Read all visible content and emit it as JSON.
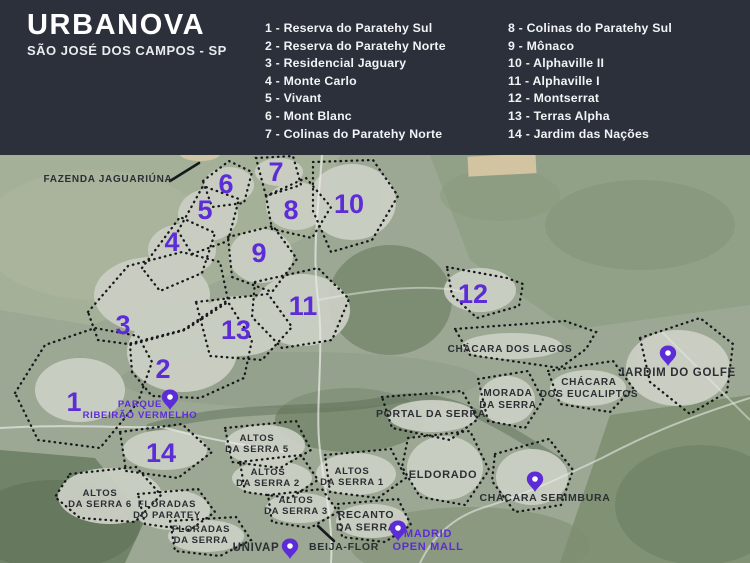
{
  "header": {
    "title": "URBANOVA",
    "subtitle": "SÃO JOSÉ DOS CAMPOS - SP",
    "legend_col1": [
      "1 - Reserva do Paratehy Sul",
      "2 - Reserva do Paratehy Norte",
      "3 - Residencial Jaguary",
      "4 - Monte Carlo",
      "5 - Vivant",
      "6 - Mont Blanc",
      "7 - Colinas do Paratehy Norte"
    ],
    "legend_col2": [
      "8 - Colinas do Paratehy Sul",
      "9 - Mônaco",
      "10 - Alphaville II",
      "11 - Alphaville I",
      "12 - Montserrat",
      "13 - Terras Alpha",
      "14 - Jardim das Nações"
    ]
  },
  "colors": {
    "header_bg": "#2b303a",
    "accent_purple": "#5c2cd6",
    "label_dark": "#2b2f34",
    "outline_dark": "#17181c"
  },
  "map": {
    "numbers": [
      {
        "n": "1",
        "x": 74,
        "y": 411
      },
      {
        "n": "2",
        "x": 163,
        "y": 378
      },
      {
        "n": "3",
        "x": 123,
        "y": 334
      },
      {
        "n": "4",
        "x": 172,
        "y": 251
      },
      {
        "n": "5",
        "x": 205,
        "y": 219
      },
      {
        "n": "6",
        "x": 226,
        "y": 193
      },
      {
        "n": "7",
        "x": 276,
        "y": 181
      },
      {
        "n": "8",
        "x": 291,
        "y": 219
      },
      {
        "n": "9",
        "x": 259,
        "y": 262
      },
      {
        "n": "10",
        "x": 349,
        "y": 213
      },
      {
        "n": "11",
        "x": 303,
        "y": 315
      },
      {
        "n": "12",
        "x": 473,
        "y": 303
      },
      {
        "n": "13",
        "x": 236,
        "y": 339
      },
      {
        "n": "14",
        "x": 161,
        "y": 462
      }
    ],
    "regions": [
      {
        "name": "reserva-do-paratehy-sul",
        "points": "15,393 45,345 95,328 138,336 152,362 138,402 100,448 38,440"
      },
      {
        "name": "reserva-do-paratehy-norte",
        "points": "132,372 130,345 185,330 228,302 252,340 244,378 200,398 152,396"
      },
      {
        "name": "residencial-jaguary",
        "points": "88,312 128,266 182,252 220,262 228,300 183,330 128,344 98,340"
      },
      {
        "name": "monte-carlo",
        "points": "142,268 180,217 215,233 202,273 160,291"
      },
      {
        "name": "vivant",
        "points": "178,231 203,186 239,199 228,241 192,254"
      },
      {
        "name": "mont-blanc",
        "points": "203,181 229,161 252,172 244,203 212,207"
      },
      {
        "name": "colinas-do-paratehy-norte",
        "points": "256,158 293,156 301,185 266,196"
      },
      {
        "name": "colinas-do-paratehy-sul",
        "points": "266,196 306,178 331,207 312,238 272,229"
      },
      {
        "name": "monaco",
        "points": "228,237 273,226 297,259 272,292 232,277"
      },
      {
        "name": "alphaville-2",
        "points": "313,162 373,160 398,196 372,240 331,252 313,211"
      },
      {
        "name": "alphaville-1",
        "points": "255,282 318,268 349,299 332,340 282,348 252,317"
      },
      {
        "name": "montserrat",
        "points": "447,267 507,278 523,284 519,306 477,318 452,295"
      },
      {
        "name": "terras-alpha",
        "points": "196,302 268,294 292,327 262,360 210,356"
      },
      {
        "name": "jardim-das-nacoes",
        "points": "120,432 182,424 212,452 178,478 126,471"
      },
      {
        "name": "altos-da-serra-5",
        "points": "225,428 296,421 311,450 280,468 232,462"
      },
      {
        "name": "altos-da-serra-2",
        "points": "240,462 301,455 318,480 290,498 245,492"
      },
      {
        "name": "altos-da-serra-1",
        "points": "325,455 391,449 406,478 378,498 330,492"
      },
      {
        "name": "altos-da-serra-3",
        "points": "268,495 322,489 338,512 310,528 272,522"
      },
      {
        "name": "altos-da-serra-6",
        "points": "70,474 136,467 161,495 135,522 80,518 55,497"
      },
      {
        "name": "floradas-do-paratey",
        "points": "138,494 198,489 215,512 190,530 145,524"
      },
      {
        "name": "floradas-da-serra",
        "points": "170,521 236,517 251,540 220,556 175,551"
      },
      {
        "name": "recanto-da-serra",
        "points": "338,504 398,499 411,525 385,542 342,537"
      },
      {
        "name": "eldorado",
        "points": "408,438 470,431 489,470 465,505 420,497 402,467"
      },
      {
        "name": "chacara-serimbura",
        "points": "495,454 549,439 573,470 561,505 515,512 492,481"
      },
      {
        "name": "morada-da-serra",
        "points": "478,379 528,371 543,400 525,428 488,421"
      },
      {
        "name": "chacara-dos-eucaliptos",
        "points": "548,371 613,361 633,388 610,412 560,404"
      },
      {
        "name": "chacara-dos-lagos",
        "points": "455,329 565,321 596,332 586,349 560,368 470,355"
      },
      {
        "name": "jardim-do-golfe",
        "points": "640,338 700,318 733,344 727,392 690,414 650,382"
      },
      {
        "name": "portal-da-serra",
        "points": "382,397 462,391 478,419 450,440 392,428"
      }
    ],
    "labels": [
      {
        "name": "fazenda-jaguariuna",
        "lines": [
          "FAZENDA JAGUARIÚNA"
        ],
        "x": 108,
        "y": 182,
        "size": 10
      },
      {
        "name": "chacara-dos-lagos",
        "lines": [
          "CHÁCARA DOS LAGOS"
        ],
        "x": 510,
        "y": 352,
        "size": 10
      },
      {
        "name": "jardim-do-golfe",
        "lines": [
          "JARDIM DO GOLFE"
        ],
        "x": 677,
        "y": 376,
        "size": 11.5
      },
      {
        "name": "chacara-dos-eucaliptos",
        "lines": [
          "CHÁCARA",
          "DOS EUCALIPTOS"
        ],
        "x": 589,
        "y": 385,
        "size": 10
      },
      {
        "name": "morada-da-serra",
        "lines": [
          "MORADA",
          "DA SERRA"
        ],
        "x": 508,
        "y": 396,
        "size": 10
      },
      {
        "name": "portal-da-serra",
        "lines": [
          "PORTAL DA SERRA"
        ],
        "x": 431,
        "y": 417,
        "size": 10.5
      },
      {
        "name": "altos-da-serra-5",
        "lines": [
          "ALTOS",
          "DA SERRA 5"
        ],
        "x": 257,
        "y": 441,
        "size": 9.5
      },
      {
        "name": "altos-da-serra-2",
        "lines": [
          "ALTOS",
          "DA SERRA 2"
        ],
        "x": 268,
        "y": 475,
        "size": 9.5
      },
      {
        "name": "altos-da-serra-1",
        "lines": [
          "ALTOS",
          "DA SERRA 1"
        ],
        "x": 352,
        "y": 474,
        "size": 9.5
      },
      {
        "name": "eldorado",
        "lines": [
          "ELDORADO"
        ],
        "x": 443,
        "y": 478,
        "size": 11
      },
      {
        "name": "altos-da-serra-6",
        "lines": [
          "ALTOS",
          "DA SERRA 6"
        ],
        "x": 100,
        "y": 496,
        "size": 9.5
      },
      {
        "name": "floradas-do-paratey",
        "lines": [
          "FLORADAS",
          "DO PARATEY"
        ],
        "x": 167,
        "y": 507,
        "size": 9.5
      },
      {
        "name": "altos-da-serra-3",
        "lines": [
          "ALTOS",
          "DA SERRA 3"
        ],
        "x": 296,
        "y": 503,
        "size": 9.5
      },
      {
        "name": "floradas-da-serra",
        "lines": [
          "FLORADAS",
          "DA SERRA"
        ],
        "x": 201,
        "y": 532,
        "size": 9.5
      },
      {
        "name": "recanto-da-serra",
        "lines": [
          "RECANTO",
          "DA SERRA"
        ],
        "x": 366,
        "y": 518,
        "size": 10.5
      },
      {
        "name": "univap",
        "lines": [
          "UNIVAP"
        ],
        "x": 256,
        "y": 551,
        "size": 11.5
      },
      {
        "name": "beija-flor",
        "lines": [
          "BEIJA-FLOR"
        ],
        "x": 344,
        "y": 550,
        "size": 10.5
      },
      {
        "name": "chacara-serimbura",
        "lines": [
          "CHÁCARA SERIMBURA"
        ],
        "x": 545,
        "y": 501,
        "size": 10.5
      },
      {
        "name": "parque-ribeirao-vermelho",
        "lines": [
          "PARQUE",
          "RIBEIRÃO VERMELHO"
        ],
        "x": 140,
        "y": 407,
        "size": 9.5,
        "color": "purple"
      },
      {
        "name": "madrid-open-mall",
        "lines": [
          "MADRID",
          "OPEN MALL"
        ],
        "x": 428,
        "y": 537,
        "size": 11,
        "color": "purple"
      }
    ],
    "pins": [
      {
        "name": "parque-ribeirao-vermelho",
        "x": 170,
        "y": 410
      },
      {
        "name": "jardim-do-golfe",
        "x": 668,
        "y": 366
      },
      {
        "name": "chacara-serimbura",
        "x": 535,
        "y": 492
      },
      {
        "name": "madrid-open-mall",
        "x": 398,
        "y": 541
      },
      {
        "name": "univap",
        "x": 290,
        "y": 559
      }
    ],
    "leader_lines": [
      {
        "name": "fazenda-jaguariuna-line",
        "x1": 170,
        "y1": 181,
        "x2": 199,
        "y2": 163
      },
      {
        "name": "beija-flor-line",
        "x1": 318,
        "y1": 526,
        "x2": 334,
        "y2": 541
      }
    ]
  }
}
